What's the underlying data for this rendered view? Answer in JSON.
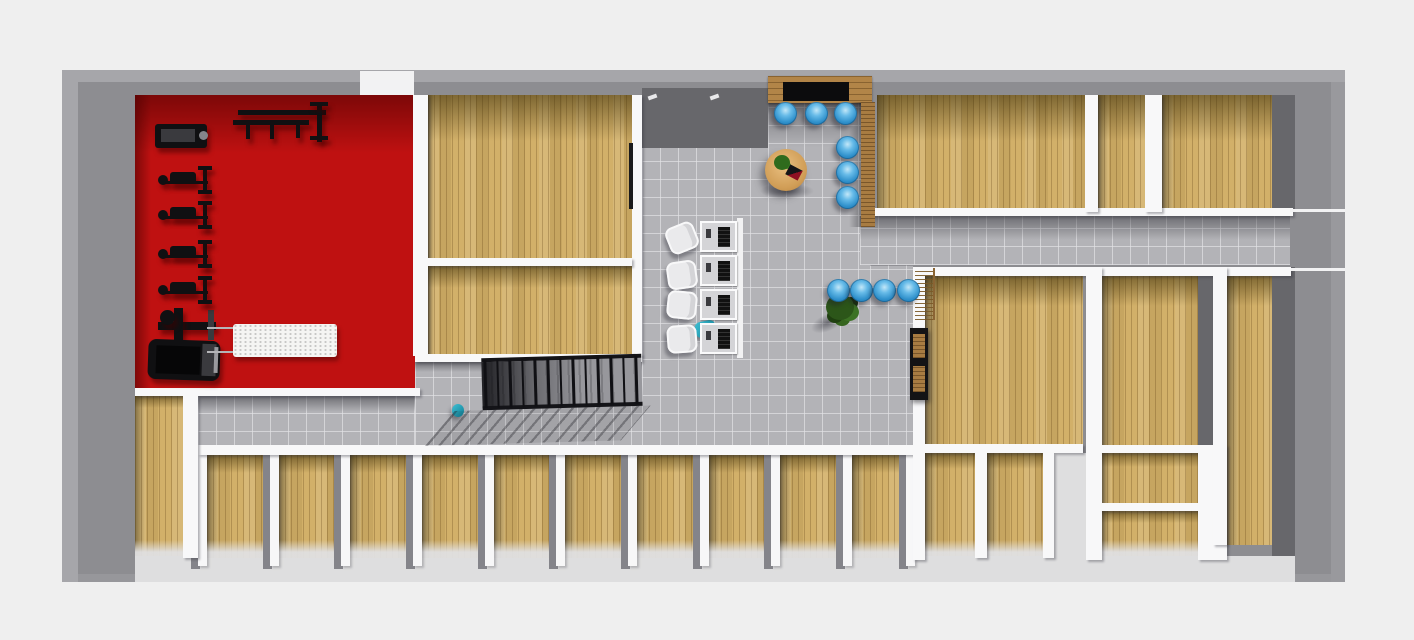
{
  "scene": {
    "type": "3d-floorplan-top-down-render",
    "description": "single-storey fitness facility floor plan, no visible text labels",
    "palette": {
      "background": "#efefef",
      "exterior_wall_gray": "#8d8d91",
      "interior_wall_white": "#f8f8f9",
      "wood_floor": "#d2b069",
      "tile_floor": "#b3b3b7",
      "gym_floor_red": "#bf1111",
      "chair_blue": "#2f90cb",
      "table_wood": "#d09d56",
      "equipment_black": "#131315",
      "plant_green": "#3c7224"
    }
  },
  "floorplan": {
    "boxes_base": [
      {
        "n": "exterior-walls",
        "c": "shell",
        "r": [
          62,
          70,
          1283,
          512
        ]
      },
      {
        "n": "top-wall-door-gap",
        "c": "wallthin",
        "r": [
          360,
          71,
          54,
          25
        ]
      },
      {
        "n": "gym-room-floor",
        "c": "red",
        "r": [
          135,
          95,
          280,
          293
        ],
        "sh": 58,
        "shl": 16
      },
      {
        "n": "studio-room-top-floor",
        "c": "wood",
        "r": [
          428,
          95,
          204,
          163
        ],
        "sh": 46,
        "shl": 6
      },
      {
        "n": "studio-room-bottom-floor",
        "c": "wood",
        "r": [
          428,
          266,
          204,
          88
        ],
        "sh": 22,
        "shl": 6
      },
      {
        "n": "lobby-floor",
        "c": "tile",
        "r": [
          642,
          95,
          228,
          355
        ],
        "sh": 52
      },
      {
        "n": "corridor-right-floor",
        "c": "tile",
        "r": [
          860,
          216,
          430,
          49
        ],
        "sh": 24
      },
      {
        "n": "stair-hall-floor",
        "c": "tile",
        "r": [
          415,
          362,
          227,
          88
        ],
        "sh": 10
      },
      {
        "n": "corridor-left-floor",
        "c": "tile",
        "r": [
          198,
          396,
          217,
          54
        ],
        "sh": 16
      },
      {
        "n": "lobby-south-floor",
        "c": "tile",
        "r": [
          870,
          265,
          43,
          185
        ]
      },
      {
        "n": "room-topright-large-floor",
        "c": "wood",
        "r": [
          877,
          95,
          208,
          117
        ],
        "sh": 46,
        "shl": 14
      },
      {
        "n": "room-topright-small-floor",
        "c": "wood",
        "r": [
          1098,
          95,
          47,
          117
        ],
        "sh": 46,
        "shl": 10
      },
      {
        "n": "room-topright-corner-floor",
        "c": "wood",
        "r": [
          1162,
          95,
          110,
          117
        ],
        "sh": 46,
        "shl": 12
      },
      {
        "n": "office-right-floor",
        "c": "wood",
        "r": [
          925,
          276,
          158,
          168
        ],
        "sh": 30,
        "shl": 16
      },
      {
        "n": "store-a-floor",
        "c": "wood fadeb",
        "r": [
          925,
          453,
          50,
          105
        ],
        "sh": 16,
        "shl": 12
      },
      {
        "n": "store-b-floor",
        "c": "wood fadeb",
        "r": [
          987,
          453,
          56,
          105
        ],
        "sh": 16,
        "shl": 12
      },
      {
        "n": "room-rightmid-floor",
        "c": "wood",
        "r": [
          1101,
          276,
          97,
          169
        ],
        "sh": 30,
        "shl": 14
      },
      {
        "n": "room-rightmid-a-floor",
        "c": "wood",
        "r": [
          1101,
          453,
          97,
          50
        ],
        "sh": 14,
        "shl": 10
      },
      {
        "n": "room-rightmid-b-floor",
        "c": "wood fadeb",
        "r": [
          1101,
          511,
          97,
          47
        ],
        "sh": 12,
        "shl": 10
      },
      {
        "n": "room-righttall-floor",
        "c": "wood",
        "r": [
          1227,
          276,
          45,
          269
        ],
        "sh": 30,
        "shl": 12
      },
      {
        "n": "room-bottomleft-floor",
        "c": "wood fadeb",
        "r": [
          135,
          396,
          48,
          162
        ],
        "sh": 12,
        "shl": 10
      },
      {
        "n": "wallface-above-lobby",
        "c": "darkface",
        "r": [
          642,
          88,
          126,
          60
        ]
      },
      {
        "n": "wallface-right-top",
        "c": "darkface",
        "r": [
          1272,
          95,
          23,
          117
        ]
      },
      {
        "n": "wallface-right-low",
        "c": "darkface",
        "r": [
          1272,
          267,
          23,
          290
        ]
      },
      {
        "n": "wallface-rightmid",
        "c": "darkface",
        "r": [
          1198,
          276,
          15,
          169
        ]
      },
      {
        "n": "open-floor-cut",
        "c": "lightcut",
        "r": [
          1054,
          453,
          32,
          105
        ]
      },
      {
        "n": "south-walkway",
        "c": "lightcut",
        "r": [
          135,
          556,
          1160,
          26
        ]
      }
    ],
    "cubicles": {
      "wall_x": [
        198,
        270,
        341,
        413,
        485,
        556,
        628,
        700,
        771,
        843,
        906
      ],
      "wall": {
        "y": 448,
        "w": 9,
        "h": 118
      },
      "floor": {
        "y": 455,
        "h": 103
      },
      "sh": 18,
      "shl": 12,
      "count": 10
    },
    "boxes_walls": [
      {
        "n": "wall-gym-east",
        "c": "wall",
        "r": [
          413,
          95,
          15,
          261
        ]
      },
      {
        "n": "wall-lobby-west",
        "c": "wall",
        "r": [
          632,
          95,
          10,
          261
        ]
      },
      {
        "n": "open-door-leaf",
        "c": "doorleaf",
        "r": [
          629,
          143,
          4,
          66
        ]
      },
      {
        "n": "wall-studio-mid",
        "c": "wall",
        "r": [
          428,
          258,
          204,
          8
        ]
      },
      {
        "n": "wall-studio-south",
        "c": "wall",
        "r": [
          415,
          354,
          227,
          8
        ]
      },
      {
        "n": "wall-gym-south",
        "c": "wall",
        "r": [
          135,
          388,
          285,
          8
        ]
      },
      {
        "n": "wall-corridor-north",
        "c": "wall",
        "r": [
          865,
          208,
          428,
          8
        ]
      },
      {
        "n": "wall-corridor-north-ext",
        "c": "wallthin",
        "r": [
          1290,
          209,
          55,
          3
        ]
      },
      {
        "n": "wall-cubicles-north",
        "c": "wall",
        "r": [
          198,
          445,
          717,
          10
        ]
      },
      {
        "n": "wall-block-north",
        "c": "wall",
        "r": [
          913,
          267,
          378,
          9
        ]
      },
      {
        "n": "wall-block-north-ext",
        "c": "wallthin",
        "r": [
          1291,
          268,
          54,
          3
        ]
      },
      {
        "n": "wall-block-west",
        "c": "wall",
        "r": [
          913,
          276,
          12,
          284
        ]
      },
      {
        "n": "wall-office-south",
        "c": "wall",
        "r": [
          925,
          444,
          158,
          9
        ]
      },
      {
        "n": "wall-store-divider",
        "c": "wall",
        "r": [
          975,
          453,
          12,
          105
        ]
      },
      {
        "n": "wall-store-east",
        "c": "wall",
        "r": [
          1043,
          453,
          11,
          105
        ]
      },
      {
        "n": "wall-block-mid",
        "c": "wall",
        "r": [
          1086,
          267,
          16,
          293
        ]
      },
      {
        "n": "wall-topright-1",
        "c": "wall",
        "r": [
          1085,
          95,
          13,
          117
        ]
      },
      {
        "n": "wall-topright-2",
        "c": "wall",
        "r": [
          1145,
          95,
          17,
          117
        ]
      },
      {
        "n": "wall-rightmid-1",
        "c": "wall",
        "r": [
          1101,
          445,
          97,
          8
        ]
      },
      {
        "n": "wall-rightmid-2",
        "c": "wall",
        "r": [
          1101,
          503,
          97,
          8
        ]
      },
      {
        "n": "wall-rightmid-east",
        "c": "wall",
        "r": [
          1198,
          445,
          29,
          115
        ]
      },
      {
        "n": "wall-righttall-west",
        "c": "wall",
        "r": [
          1213,
          267,
          14,
          278
        ]
      },
      {
        "n": "wall-bottomleft-east",
        "c": "wall",
        "r": [
          183,
          396,
          15,
          162
        ]
      },
      {
        "n": "door-handle-tick-1",
        "c": "tick",
        "r": [
          648,
          95,
          9,
          4
        ]
      },
      {
        "n": "door-handle-tick-2",
        "c": "tick",
        "r": [
          710,
          95,
          9,
          4
        ]
      }
    ],
    "boxes_deco": [
      {
        "n": "entrance-canopy",
        "c": "planks",
        "r": [
          768,
          76,
          104,
          27
        ]
      },
      {
        "n": "entrance-doormat",
        "c": "mat",
        "r": [
          783,
          82,
          66,
          19
        ]
      },
      {
        "n": "entrance-canopy-shadow",
        "c": "shadeD",
        "r": [
          768,
          103,
          104,
          12
        ]
      },
      {
        "n": "entrance-wood-sidewall",
        "c": "planksV",
        "r": [
          861,
          102,
          14,
          125
        ]
      },
      {
        "n": "entrance-sidewall-shadow",
        "c": "shadeL",
        "r": [
          849,
          102,
          12,
          125
        ]
      },
      {
        "n": "gym-machine-top",
        "c": "gblk r3",
        "r": [
          155,
          124,
          52,
          24
        ]
      },
      {
        "n": "gym-machine-top-inner",
        "c": "blk2",
        "r": [
          161,
          129,
          34,
          13
        ]
      },
      {
        "n": "gym-machine-top-knob",
        "c": "knobgray round",
        "r": [
          199,
          131,
          9,
          9
        ]
      },
      {
        "n": "gym-wallrack-bar1",
        "c": "gblk",
        "r": [
          238,
          110,
          88,
          5
        ]
      },
      {
        "n": "gym-wallrack-bar2",
        "c": "gblk",
        "r": [
          233,
          120,
          76,
          5
        ]
      },
      {
        "n": "gym-wallrack-leg1",
        "c": "gblk",
        "r": [
          246,
          125,
          4,
          14
        ]
      },
      {
        "n": "gym-wallrack-leg2",
        "c": "gblk",
        "r": [
          270,
          125,
          4,
          14
        ]
      },
      {
        "n": "gym-wallrack-leg3",
        "c": "gblk",
        "r": [
          296,
          122,
          4,
          16
        ]
      },
      {
        "n": "gym-wallrack-vbar",
        "c": "gblk",
        "r": [
          317,
          104,
          5,
          38
        ]
      },
      {
        "n": "gym-wallrack-cap1",
        "c": "gblk",
        "r": [
          310,
          102,
          18,
          4
        ]
      },
      {
        "n": "gym-wallrack-cap2",
        "c": "gblk",
        "r": [
          310,
          136,
          18,
          4
        ]
      },
      {
        "n": "gym-machine-mid-hbar",
        "c": "gblk",
        "r": [
          158,
          322,
          58,
          8
        ]
      },
      {
        "n": "gym-machine-mid-vbar",
        "c": "gblk",
        "r": [
          174,
          308,
          9,
          32
        ]
      },
      {
        "n": "gym-machine-mid-knob",
        "c": "gblk round",
        "r": [
          160,
          310,
          15,
          15
        ]
      },
      {
        "n": "gym-machine-mid-cap",
        "c": "blk2",
        "r": [
          208,
          310,
          6,
          30
        ]
      },
      {
        "n": "gym-treadmill-base",
        "c": "gblk",
        "r": [
          148,
          340,
          72,
          40
        ],
        "rot": 2,
        "rad": 8
      },
      {
        "n": "gym-treadmill-belt",
        "c": "blkdeep",
        "r": [
          156,
          346,
          44,
          28
        ],
        "rot": 2
      },
      {
        "n": "gym-treadmill-rail",
        "c": "blk2",
        "r": [
          202,
          344,
          14,
          32
        ],
        "rot": 2
      },
      {
        "n": "gym-treadmill-highlight",
        "c": "grayhl",
        "r": [
          214,
          347,
          4,
          26
        ],
        "rot": 2
      },
      {
        "n": "gym-table-frame-line1",
        "c": "grayline",
        "r": [
          207,
          327,
          26,
          2
        ]
      },
      {
        "n": "gym-table-frame-line2",
        "c": "grayline",
        "r": [
          207,
          351,
          26,
          2
        ]
      },
      {
        "n": "gym-massage-table",
        "c": "speckle",
        "r": [
          233,
          324,
          104,
          33
        ]
      },
      {
        "n": "reception-desk-frame",
        "c": "wallthin",
        "r": [
          737,
          218,
          6,
          140
        ]
      },
      {
        "n": "reception-teal-bag",
        "c": "teal",
        "r": [
          695,
          321,
          21,
          16
        ],
        "rot": -12,
        "rad": 6
      },
      {
        "n": "lounge-table-shadow",
        "c": "shadowblob",
        "r": [
          760,
          183,
          54,
          16
        ]
      },
      {
        "n": "lounge-coffee-table",
        "c": "tableround",
        "r": [
          765,
          149,
          42,
          42
        ]
      },
      {
        "n": "lounge-table-plant",
        "c": "plantS",
        "r": [
          774,
          155,
          16,
          15
        ]
      },
      {
        "n": "lounge-table-book",
        "c": "book",
        "r": [
          787,
          167,
          14,
          11
        ],
        "rot": 28
      },
      {
        "n": "lobby-plant-shadow",
        "c": "shadowblob",
        "r": [
          810,
          314,
          36,
          17
        ],
        "rot": -24
      },
      {
        "n": "lobby-plant",
        "c": "plantbig",
        "r": [
          826,
          294,
          28,
          26
        ]
      },
      {
        "n": "slat-screen",
        "c": "slats",
        "r": [
          915,
          268,
          20,
          52
        ]
      },
      {
        "n": "office-shelf-frame",
        "c": "blk",
        "r": [
          910,
          328,
          18,
          72
        ]
      },
      {
        "n": "office-shelf-board1",
        "c": "planksV",
        "r": [
          913,
          334,
          12,
          24
        ]
      },
      {
        "n": "office-shelf-board2",
        "c": "planksV",
        "r": [
          913,
          366,
          12,
          26
        ]
      },
      {
        "n": "stairhall-teal-item",
        "c": "teal round",
        "r": [
          452,
          404,
          12,
          13
        ]
      }
    ],
    "benches": {
      "x": 158,
      "ys": [
        166,
        201,
        240,
        276
      ],
      "parts": [
        [
          0,
          9,
          10,
          10,
          "gblk round"
        ],
        [
          12,
          6,
          26,
          12,
          "gblk r3"
        ],
        [
          8,
          15,
          42,
          3,
          "gblk"
        ],
        [
          45,
          1,
          4,
          27,
          "gblk"
        ],
        [
          40,
          0,
          14,
          4,
          "gblk"
        ],
        [
          40,
          24,
          14,
          4,
          "gblk"
        ]
      ]
    },
    "blue_chairs": {
      "size": 23,
      "centers": [
        [
          785,
          113
        ],
        [
          816,
          113
        ],
        [
          845,
          113
        ],
        [
          847,
          147
        ],
        [
          847,
          172
        ],
        [
          847,
          197
        ],
        [
          838,
          290
        ],
        [
          861,
          290
        ],
        [
          884,
          290
        ],
        [
          908,
          290
        ]
      ]
    },
    "desks": {
      "x": 700,
      "y0": 221,
      "pitch": 34,
      "count": 4,
      "w": 37,
      "h": 31
    },
    "desk_chairs": [
      [
        667,
        224,
        -22
      ],
      [
        667,
        261,
        -8
      ],
      [
        667,
        291,
        6
      ],
      [
        667,
        325,
        -4
      ]
    ],
    "stairs": {
      "x": 482,
      "y": 356,
      "w": 160,
      "h": 56,
      "posts": 13,
      "post_gap": 12.6,
      "rails": [
        [
          0,
          0,
          160,
          4
        ],
        [
          0,
          48,
          160,
          4
        ]
      ],
      "treads": [
        0,
        4,
        160,
        46
      ],
      "shadow": [
        -28,
        52,
        196,
        34
      ]
    }
  }
}
